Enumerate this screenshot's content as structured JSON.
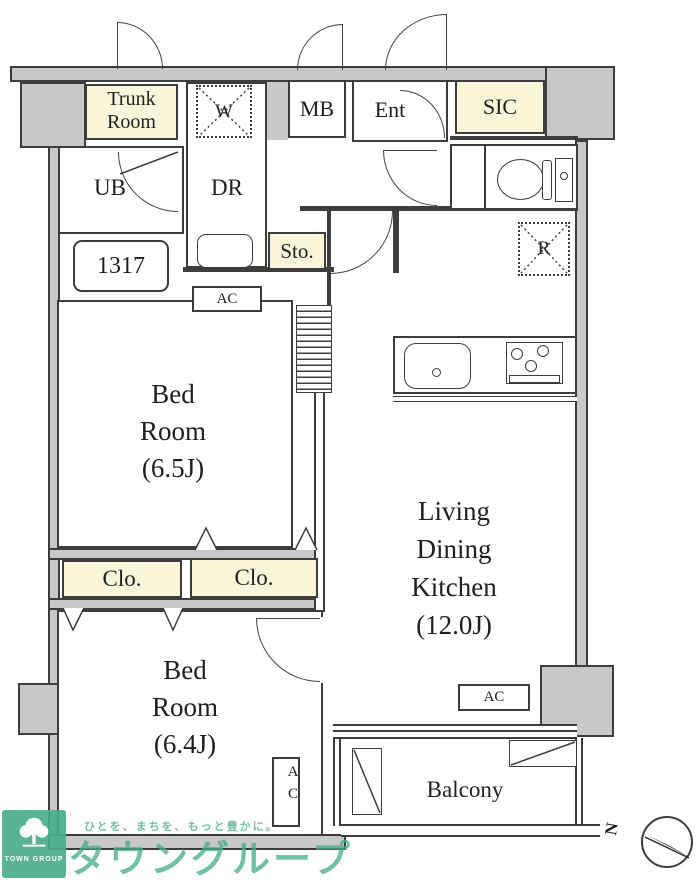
{
  "colors": {
    "wall_gray": "#c8c8c8",
    "cream": "#f9f5d8",
    "line_dark": "#3d3d3d",
    "brand_green": "#4aae8b",
    "tagline_green": "#6cbda1"
  },
  "rooms": {
    "trunk_room": {
      "line1": "Trunk",
      "line2": "Room"
    },
    "washer": "W",
    "mail_box": "MB",
    "entrance": "Ent",
    "shoe_closet": "SIC",
    "bath": "UB",
    "dressing_room": "DR",
    "unit_number": "1317",
    "storage": "Sto.",
    "refrigerator": "R",
    "bedroom_65": {
      "line1": "Bed",
      "line2": "Room",
      "line3": "(6.5J)"
    },
    "ldk": {
      "line1": "Living",
      "line2": "Dining",
      "line3": "Kitchen",
      "line4": "(12.0J)"
    },
    "closet_left": "Clo.",
    "closet_right": "Clo.",
    "bedroom_64": {
      "line1": "Bed",
      "line2": "Room",
      "line3": "(6.4J)"
    },
    "balcony": "Balcony"
  },
  "equipment": {
    "ac_bedroom_65": "AC",
    "ac_ldk": "AC",
    "ac_bedroom_64": "AC"
  },
  "compass": {
    "north_label": "N"
  },
  "watermark": {
    "tagline": "ひとを、まちを、もっと豊かに。",
    "brand_name": "タウングループ",
    "logo_caption": "TOWN GROUP"
  }
}
